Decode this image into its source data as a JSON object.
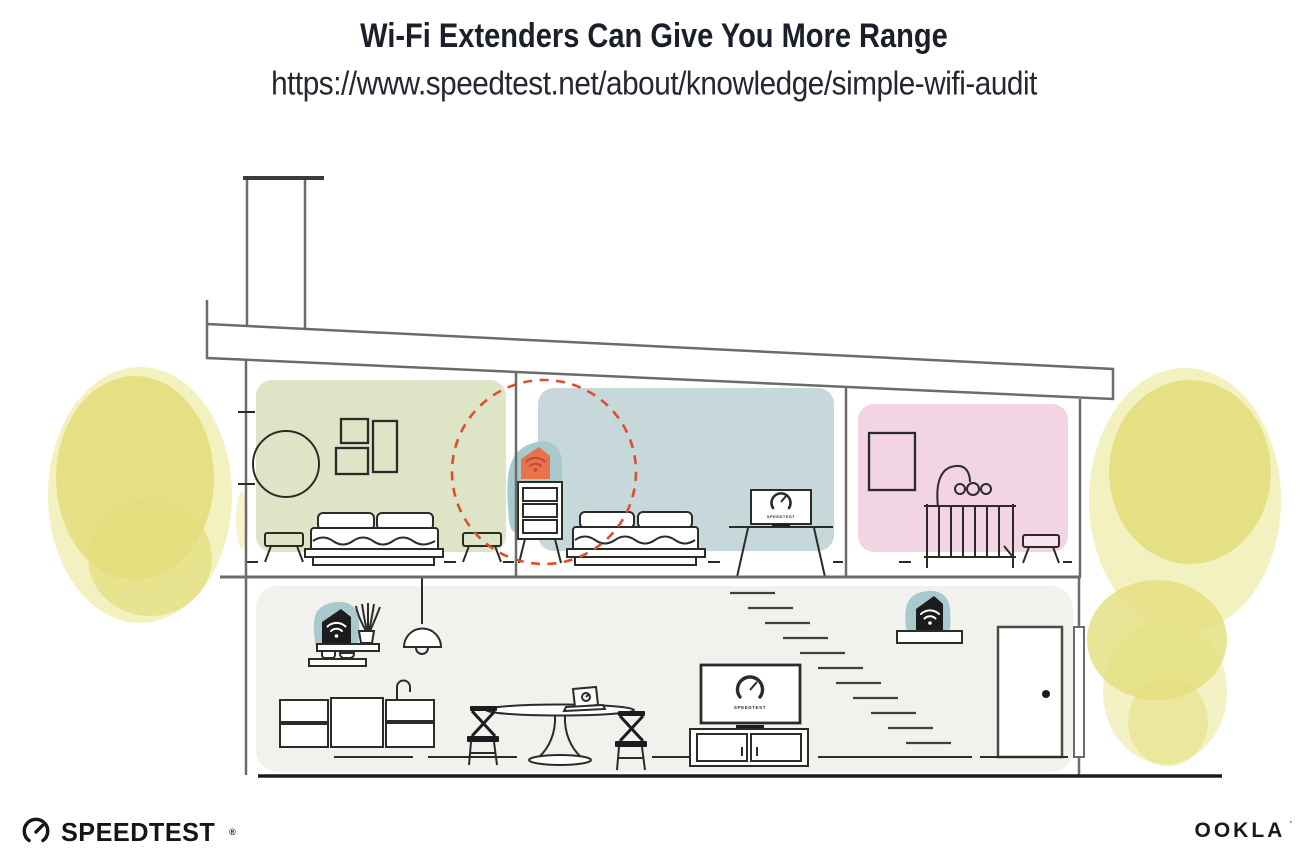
{
  "header": {
    "title": "Wi-Fi Extenders Can Give You More Range",
    "url": "https://www.speedtest.net/about/knowledge/simple-wifi-audit"
  },
  "illustration": {
    "screen_label": "SPEEDTEST",
    "colors": {
      "room_green": "#dde5c6",
      "room_blue": "#c6d8da",
      "room_pink": "#f2d4e5",
      "floor_gray": "#f1f1ee",
      "teal_halo": "#a8c9cd",
      "extender_orange": "#e8714e",
      "extender_orange_icon": "#bf4e2b",
      "device_black": "#1a1c1d",
      "range_dashed": "#dc4f2e",
      "foliage_yellow": "#e4de7d",
      "foliage_yellow_light": "#efecab",
      "line_structure": "#6b6b67",
      "line_furniture": "#2b2b28",
      "line_ground": "#1d1d1b"
    },
    "icons": {
      "bedroom_device": "wifi-extender-icon",
      "kitchen_device": "wifi-router-icon",
      "living_device": "wifi-extender-icon",
      "screens": "speedtest-gauge-icon"
    }
  },
  "footer": {
    "speedtest_label": "SPEEDTEST",
    "speedtest_mark": "®",
    "ookla_label": "OOKLA",
    "ookla_mark": "’"
  }
}
